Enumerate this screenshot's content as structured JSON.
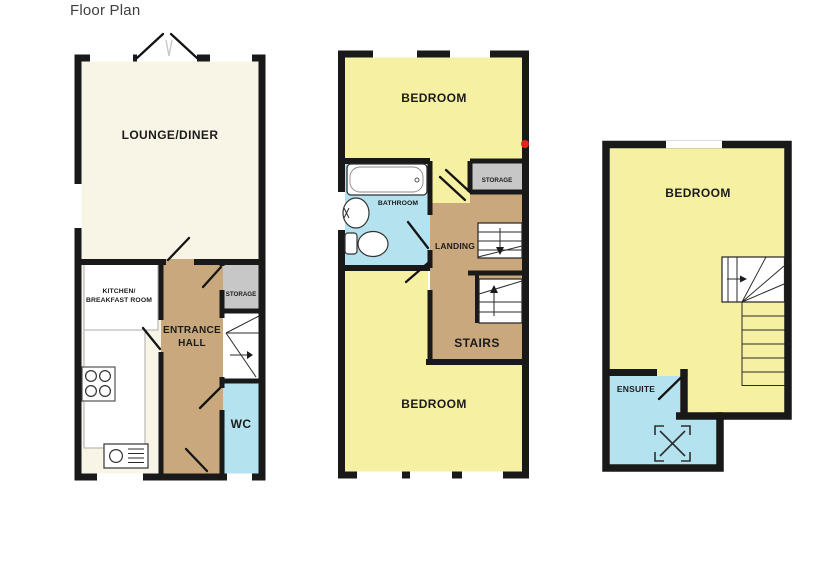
{
  "title": "Floor Plan",
  "colors": {
    "wall": "#191919",
    "cream": "#f8f4e6",
    "yellow": "#f5f0a2",
    "tan": "#c8a87c",
    "blue": "#b4e2ef",
    "gray": "#c7c7c7",
    "white": "#ffffff",
    "marker_red": "#e5251c"
  },
  "ground_floor": {
    "lounge_label": "LOUNGE/DINER",
    "kitchen_label_line1": "KITCHEN/",
    "kitchen_label_line2": "BREAKFAST ROOM",
    "hall_label_line1": "ENTRANCE",
    "hall_label_line2": "HALL",
    "storage_label": "STORAGE",
    "wc_label": "WC"
  },
  "first_floor": {
    "front_bedroom_label": "BEDROOM",
    "bathroom_label": "BATHROOM",
    "storage_label": "STORAGE",
    "landing_label": "LANDING",
    "stairs_label": "STAIRS",
    "back_bedroom_label": "BEDROOM"
  },
  "second_floor": {
    "bedroom_label": "BEDROOM",
    "ensuite_label": "ENSUITE"
  }
}
